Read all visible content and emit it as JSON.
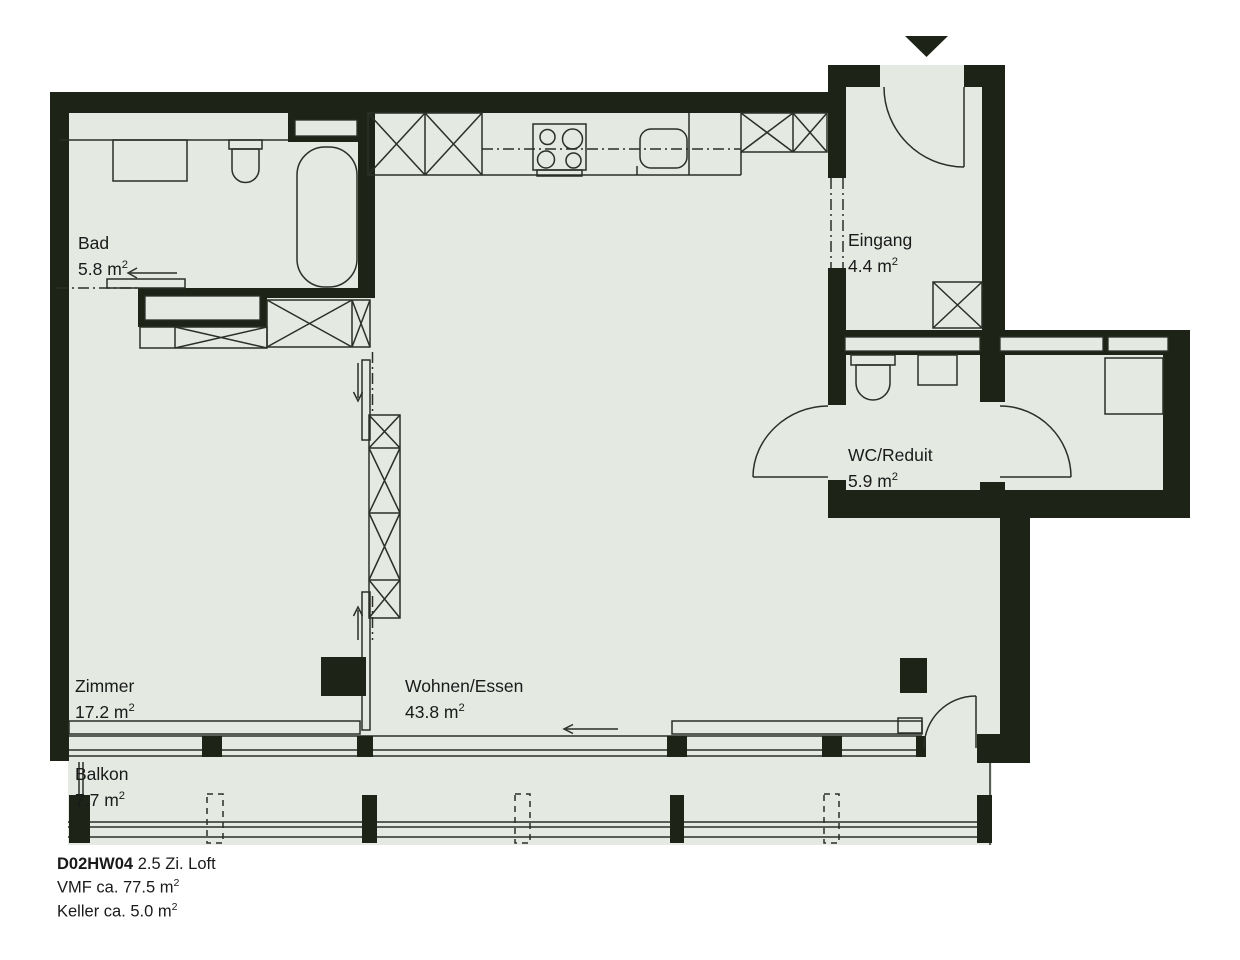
{
  "floorplan": {
    "colors": {
      "wall": "#1e2318",
      "floor": "#e4e9e2",
      "line": "#2b2f26",
      "background": "#ffffff",
      "text": "#1a1a1a"
    },
    "rooms": [
      {
        "name": "Bad",
        "area": "5.8 m²"
      },
      {
        "name": "Eingang",
        "area": "4.4 m²"
      },
      {
        "name": "WC/Reduit",
        "area": "5.9 m²"
      },
      {
        "name": "Zimmer",
        "area": "17.2 m²"
      },
      {
        "name": "Wohnen/Essen",
        "area": "43.8 m²"
      },
      {
        "name": "Balkon",
        "area": "7.7 m²"
      }
    ],
    "title": {
      "code": "D02HW04",
      "name": "2.5 Zi. Loft",
      "line2": "VMF ca. 77.5 m²",
      "line3": "Keller ca. 5.0 m²"
    }
  }
}
